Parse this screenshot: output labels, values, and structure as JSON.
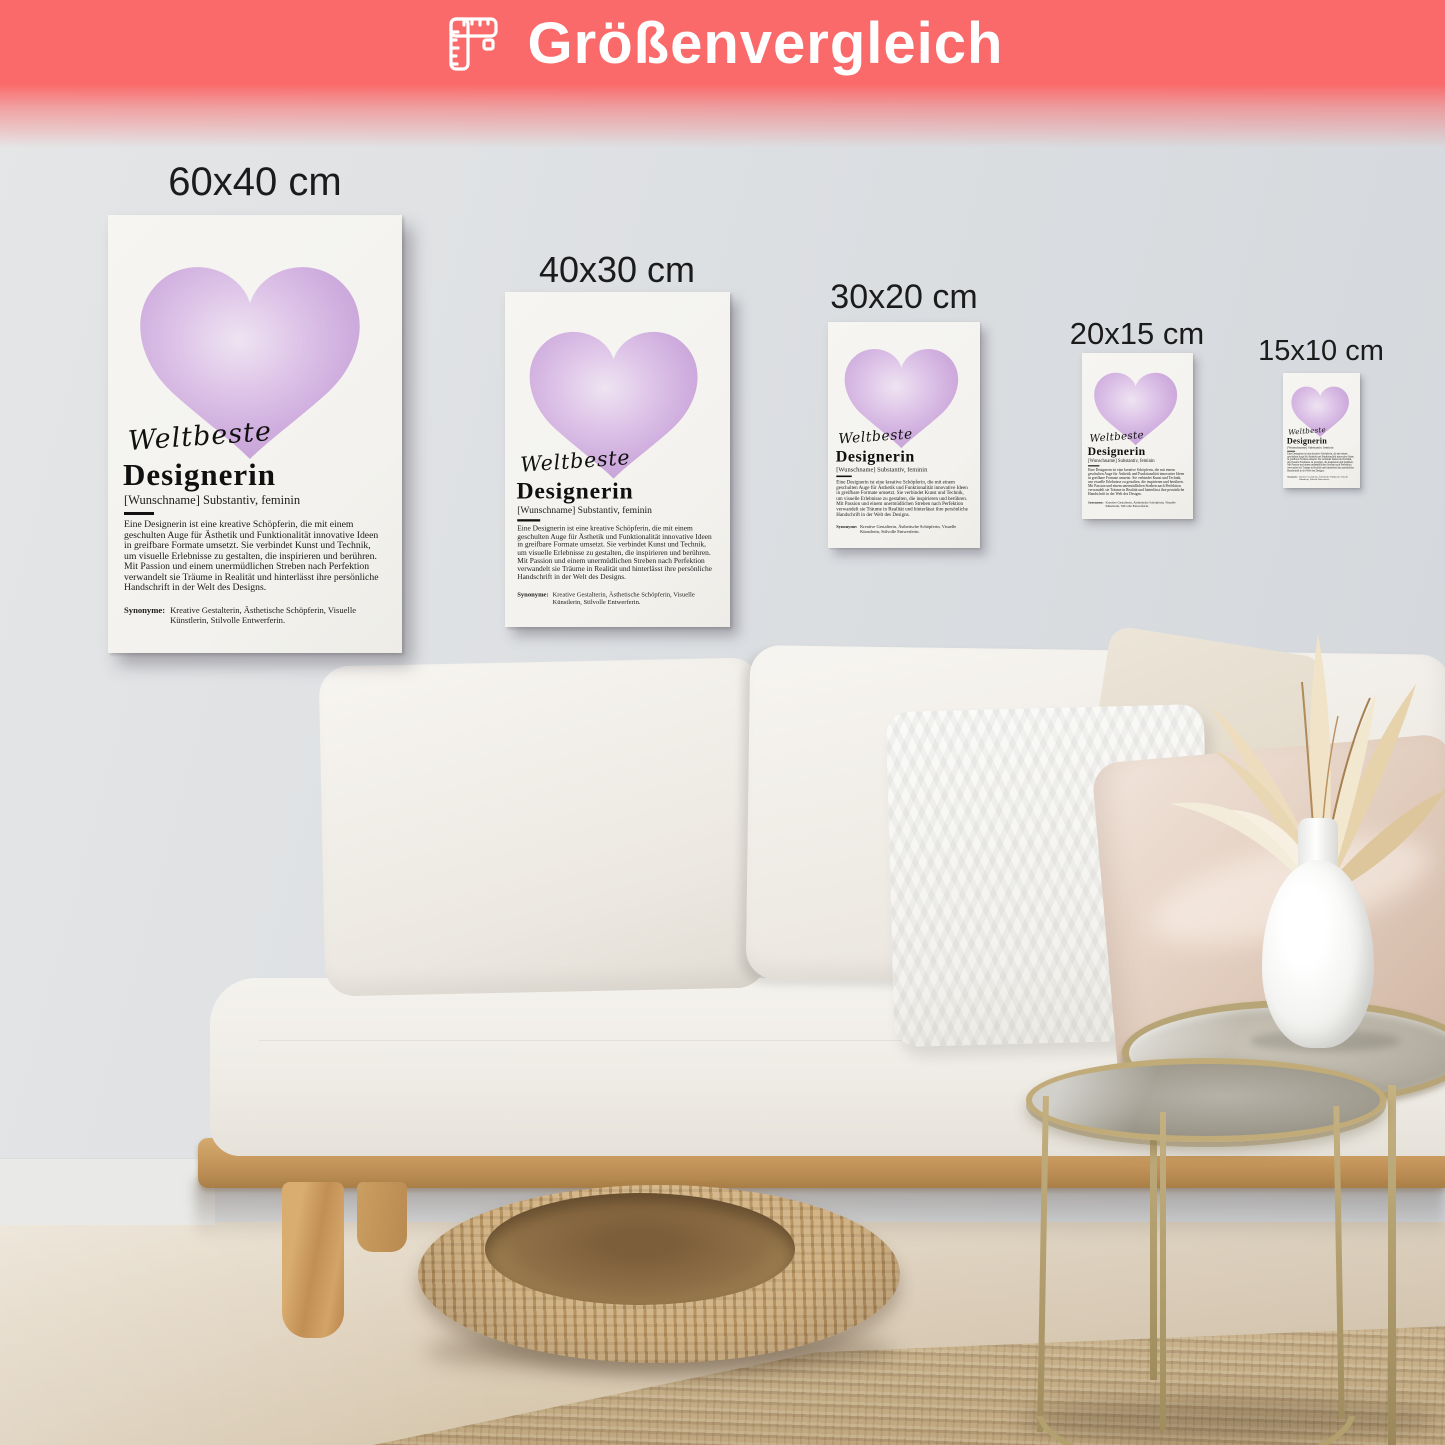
{
  "banner": {
    "label": "Größenvergleich",
    "background_color": "#fb6a6a",
    "text_color": "#ffffff",
    "icon": "ruler-icon"
  },
  "poster": {
    "script_heading": "Weltbeste",
    "title": "Designerin",
    "subtitle": "[Wunschname] Substantiv, feminin",
    "body": "Eine Designerin ist eine kreative Schöpferin, die mit einem geschulten Auge für Ästhetik und Funktionalität innovative Ideen in greifbare Formate umsetzt. Sie verbindet Kunst und Technik, um visuelle Erlebnisse zu gestalten, die inspirieren und berühren. Mit Passion und einem unermüdlichen Streben nach Perfektion verwandelt sie Träume in Realität und hinterlässt ihre persönliche Handschrift in der Welt des Designs.",
    "synonyms_label": "Synonyme:",
    "synonyms": "Kreative Gestalterin, Ästhetische Schöpferin, Visuelle Künstlerin, Stilvolle Entwerferin.",
    "heart_color": "#c9a3dc"
  },
  "sizes": [
    {
      "label": "60x40 cm"
    },
    {
      "label": "40x30 cm"
    },
    {
      "label": "30x20 cm"
    },
    {
      "label": "20x15 cm"
    },
    {
      "label": "15x10 cm"
    }
  ]
}
